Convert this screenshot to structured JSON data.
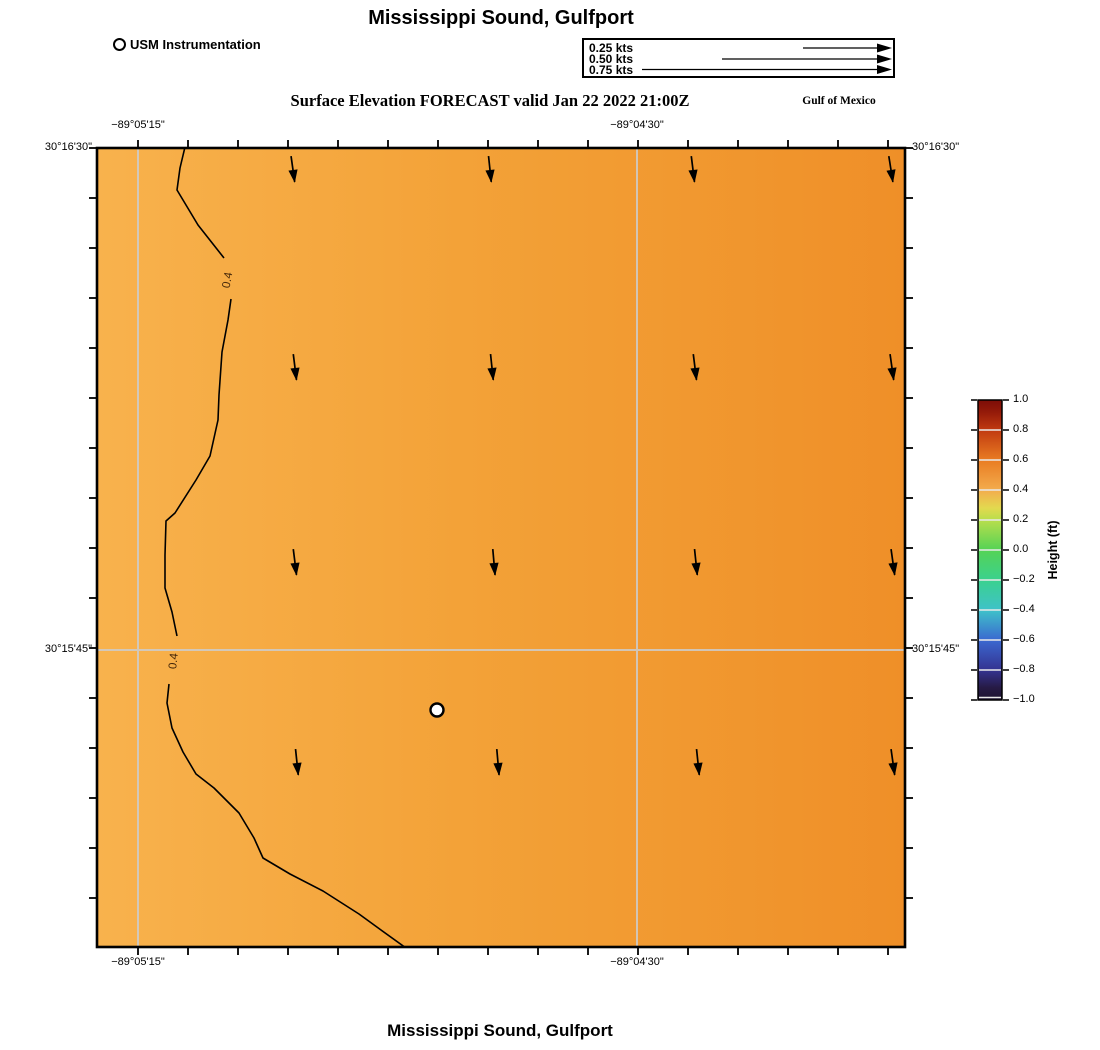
{
  "page": {
    "title_top": "Mississippi Sound, Gulfport",
    "subtitle": "Surface Elevation FORECAST valid Jan 22 2022 21:00Z",
    "region_label": "Gulf of Mexico",
    "title_bottom": "Mississippi Sound, Gulfport"
  },
  "legend": {
    "instrumentation_label": "USM Instrumentation",
    "speed_labels": [
      "0.25 kts",
      "0.50 kts",
      "0.75 kts"
    ]
  },
  "axes": {
    "lon_ticks": [
      "−89°05'15\"",
      "−89°04'30\""
    ],
    "lat_ticks": [
      "30°16'30\"",
      "30°15'45\""
    ]
  },
  "contour": {
    "label": "0.4"
  },
  "colorbar": {
    "label": "Height (ft)",
    "ticks": [
      "1.0",
      "0.8",
      "0.6",
      "0.4",
      "0.2",
      "0.0",
      "−0.2",
      "−0.4",
      "−0.6",
      "−0.8",
      "−1.0"
    ]
  },
  "colors": {
    "field_west": "#f8b24d",
    "field_east": "#ef8f28",
    "contour_line": "#000000",
    "contour_label": "#46280a",
    "gridline": "#cdcdcd"
  },
  "chart_data": {
    "type": "heatmap",
    "title": "Mississippi Sound, Gulfport",
    "subtitle": "Surface Elevation FORECAST valid Jan 22 2022 21:00Z",
    "region": "Gulf of Mexico",
    "x_axis": {
      "label": "Longitude",
      "tick_labels": [
        "−89°05'15\"",
        "−89°04'30\""
      ]
    },
    "y_axis": {
      "label": "Latitude",
      "tick_labels": [
        "30°16'30\"",
        "30°15'45\""
      ]
    },
    "colorbar": {
      "label": "Height (ft)",
      "min": -1.0,
      "max": 1.0,
      "tick_values": [
        1.0,
        0.8,
        0.6,
        0.4,
        0.2,
        0.0,
        -0.2,
        -0.4,
        -0.6,
        -0.8,
        -1.0
      ]
    },
    "contour_levels_ft": [
      0.4
    ],
    "field_description": "Surface elevation about 0.35-0.40 ft west of the 0.4 contour and 0.40-0.55 ft east of it; values increase from west to east",
    "current_vectors": {
      "grid_rows": 4,
      "grid_cols": 4,
      "direction": "southward (slight westward lean)",
      "speed_relative_to_scale": "shorter than 0.25 kts reference",
      "scale_kts": [
        0.25,
        0.5,
        0.75
      ]
    },
    "station": {
      "name": "USM Instrumentation",
      "marker": "white circle with black outline"
    }
  }
}
